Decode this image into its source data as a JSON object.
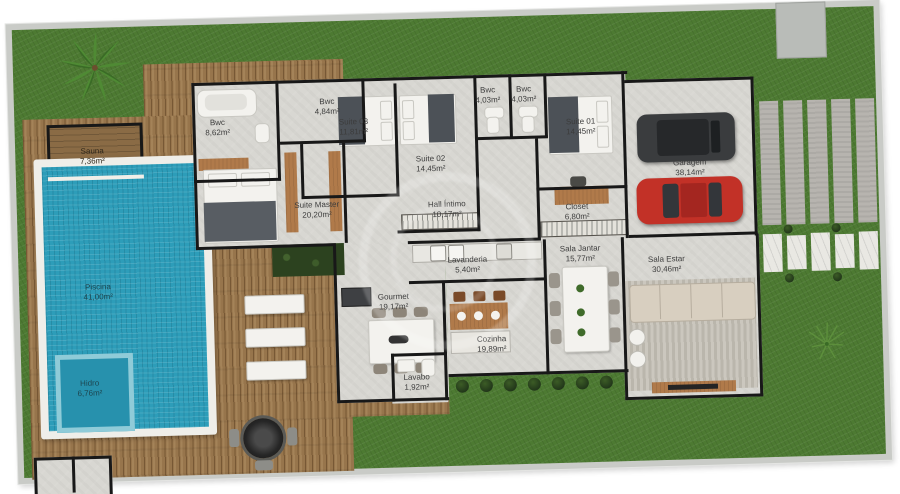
{
  "palette": {
    "grass": "#4d7a32",
    "deck_wood": "#97754c",
    "pool_water": "#2d9db9",
    "floor_concrete": "#d8d7d2",
    "wall": "#181818",
    "boundary_band": "#c9cbc7",
    "car_red": "#c23127",
    "car_dark": "#3a3c3e",
    "sofa_beige": "#d8cfc0",
    "hedge_green": "#2c421f"
  },
  "plan": {
    "rooms": [
      {
        "name": "Sauna",
        "area": "7,36m²"
      },
      {
        "name": "Piscina",
        "area": "41,00m²"
      },
      {
        "name": "Hidro",
        "area": "6,76m²"
      },
      {
        "name": "Bwc",
        "area": "8,62m²"
      },
      {
        "name": "Suite 03",
        "area": "11,81m²"
      },
      {
        "name": "Bwc",
        "area": "4,84m²"
      },
      {
        "name": "Suite 02",
        "area": "14,45m²"
      },
      {
        "name": "Bwc",
        "area": "4,03m²"
      },
      {
        "name": "Bwc",
        "area": "4,03m²"
      },
      {
        "name": "Suite 01",
        "area": "14,45m²"
      },
      {
        "name": "Garagem",
        "area": "38,14m²"
      },
      {
        "name": "Suite Master",
        "area": "20,20m²"
      },
      {
        "name": "Hall Íntimo",
        "area": "10,17m²"
      },
      {
        "name": "Closet",
        "area": "6,80m²"
      },
      {
        "name": "Lavanderia",
        "area": "5,40m²"
      },
      {
        "name": "Sala Jantar",
        "area": "15,77m²"
      },
      {
        "name": "Sala Estar",
        "area": "30,46m²"
      },
      {
        "name": "Gourmet",
        "area": "19,17m²"
      },
      {
        "name": "Cozinha",
        "area": "19,89m²"
      },
      {
        "name": "Lavabo",
        "area": "1,92m²"
      }
    ]
  }
}
